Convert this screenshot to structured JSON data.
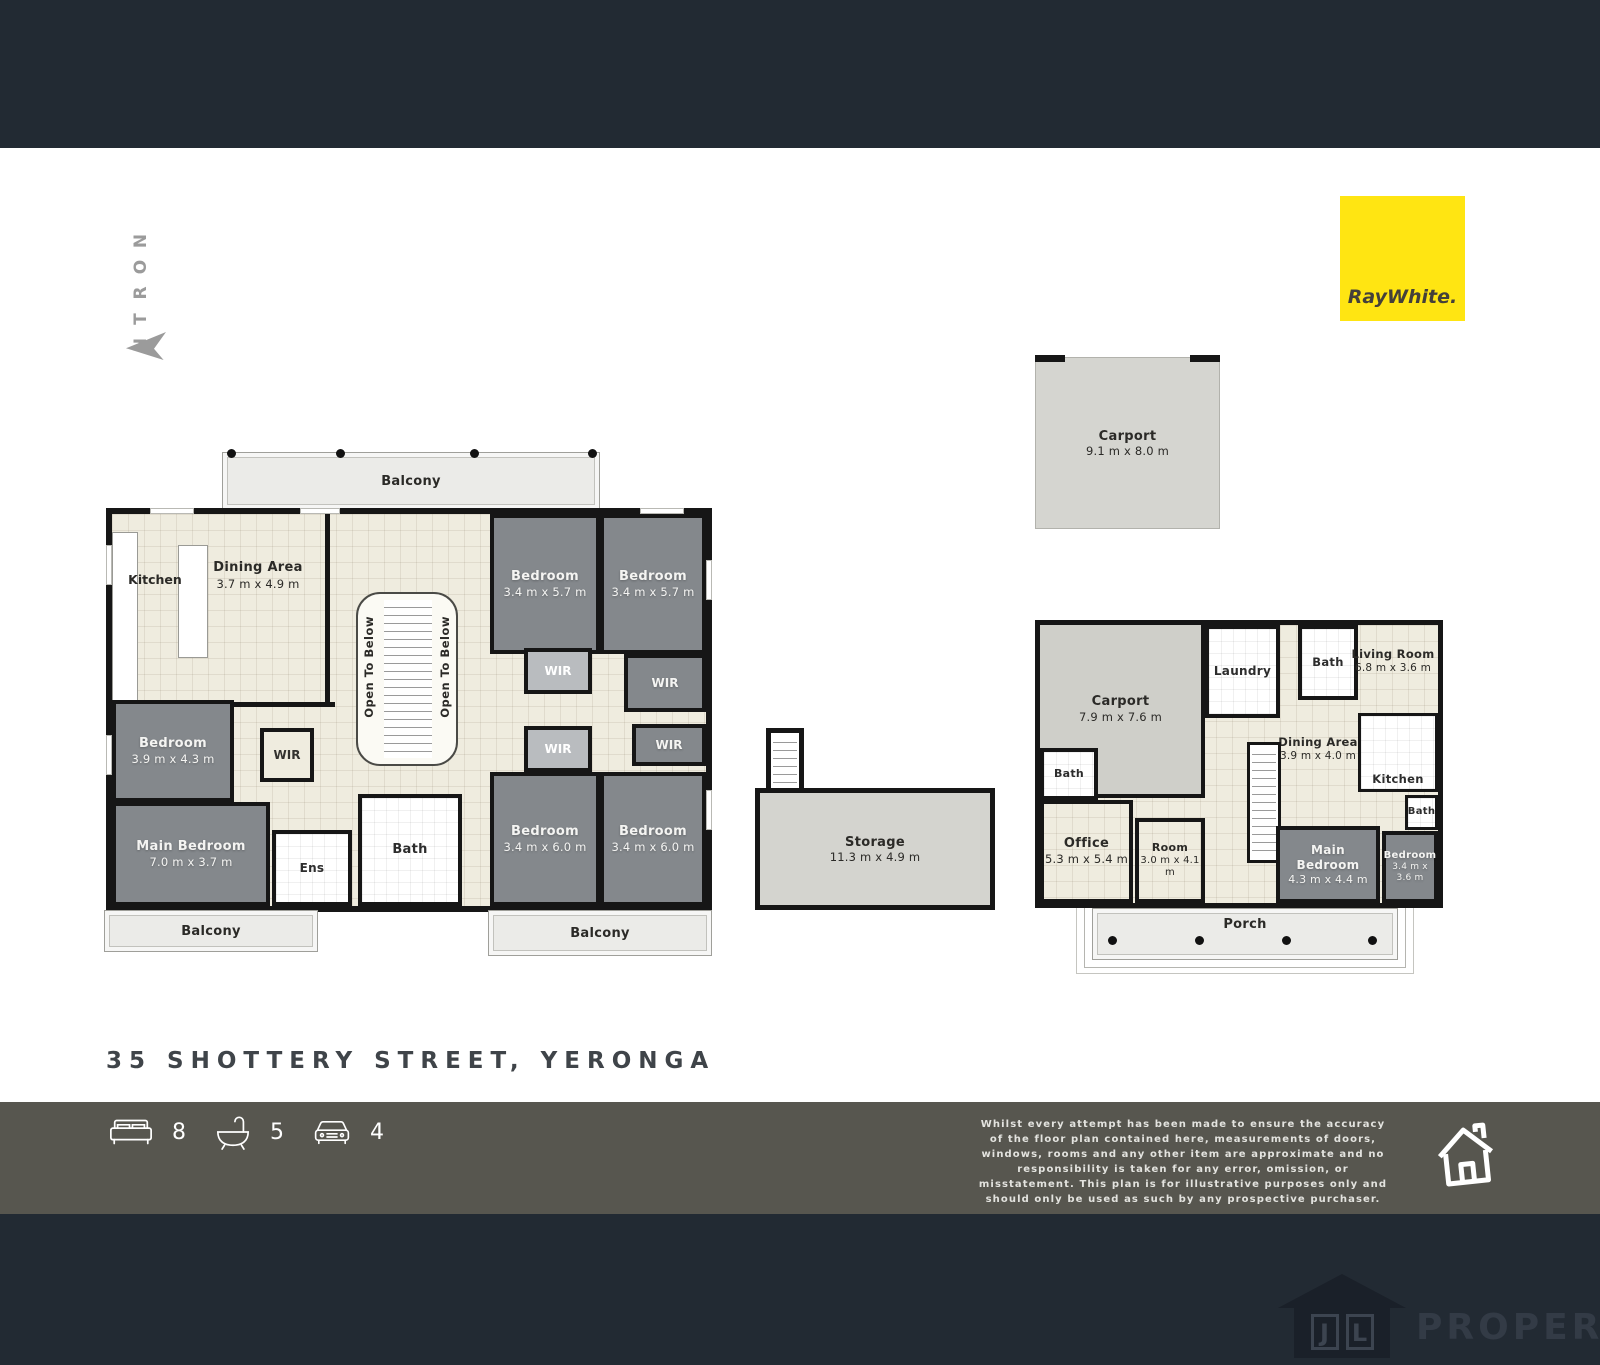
{
  "colors": {
    "header_navy": "#222a33",
    "stats_bar": "#57564f",
    "brand_yellow": "#ffe512",
    "wall": "#161616",
    "bedroom_fill": "#84888c",
    "floor_cream": "#efecdf"
  },
  "north": {
    "label": "NORTH",
    "letters": [
      "N",
      "O",
      "R",
      "T",
      "H"
    ]
  },
  "brand": {
    "logo_text": "RayWhite."
  },
  "upper_carport": {
    "name": "Carport",
    "dims": "9.1 m x 8.0 m"
  },
  "storage": {
    "name": "Storage",
    "dims": "11.3 m x 4.9 m"
  },
  "upper_floor": {
    "balconies": [
      "Balcony",
      "Balcony",
      "Balcony"
    ],
    "wir": "WIR",
    "open_to_below": "Open To Below",
    "rooms": [
      {
        "name": "Kitchen",
        "dims": ""
      },
      {
        "name": "Dining Area",
        "dims": "3.7 m x 4.9 m"
      },
      {
        "name": "Bedroom",
        "dims": "3.4 m x 5.7 m"
      },
      {
        "name": "Bedroom",
        "dims": "3.4 m x 5.7 m"
      },
      {
        "name": "Bedroom",
        "dims": "3.9 m x 4.3 m"
      },
      {
        "name": "Main Bedroom",
        "dims": "7.0 m x 3.7 m"
      },
      {
        "name": "Ens",
        "dims": ""
      },
      {
        "name": "Bath",
        "dims": ""
      },
      {
        "name": "Bedroom",
        "dims": "3.4 m x 6.0 m"
      },
      {
        "name": "Bedroom",
        "dims": "3.4 m x 6.0 m"
      }
    ]
  },
  "ground_floor": {
    "porch": "Porch",
    "rooms": [
      {
        "name": "Carport",
        "dims": "7.9 m x 7.6 m"
      },
      {
        "name": "Laundry",
        "dims": ""
      },
      {
        "name": "Bath",
        "dims": ""
      },
      {
        "name": "Living Room",
        "dims": "6.8 m x 3.6 m"
      },
      {
        "name": "Bath",
        "dims": ""
      },
      {
        "name": "Dining Area",
        "dims": "3.9 m x 4.0 m"
      },
      {
        "name": "Kitchen",
        "dims": ""
      },
      {
        "name": "Bath",
        "dims": ""
      },
      {
        "name": "Office",
        "dims": "5.3 m x 5.4 m"
      },
      {
        "name": "Room",
        "dims": "3.0 m x 4.1 m"
      },
      {
        "name": "Main Bedroom",
        "dims": "4.3 m x 4.4 m"
      },
      {
        "name": "Bedroom",
        "dims": "3.4 m x 3.6 m"
      }
    ]
  },
  "address": "35 SHOTTERY STREET, YERONGA",
  "stats": {
    "beds": "8",
    "baths": "5",
    "cars": "4"
  },
  "disclaimer": "Whilst every attempt has been made to ensure the accuracy of the floor plan contained here, measurements of doors, windows, rooms and any other item are approximate and no responsibility is taken for any error, omission, or misstatement. This plan is for illustrative purposes only and should only be used as such by any prospective purchaser.",
  "watermark": {
    "jl_j": "J",
    "jl_l": "L",
    "property": "PROPERTY"
  }
}
